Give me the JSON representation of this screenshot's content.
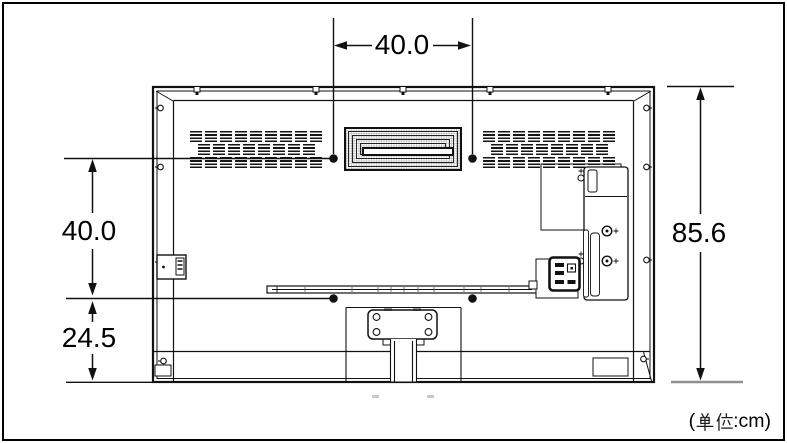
{
  "diagram": {
    "dimension_labels": {
      "top_width": "40.0",
      "side_upper": "40.0",
      "side_lower": "24.5",
      "height": "85.6"
    },
    "unit_note": {
      "open": "(",
      "kanji": "単位",
      "suffix": ":cm)"
    },
    "colors": {
      "line": "#111111",
      "background": "#ffffff",
      "muted_extension_line": "#909090"
    }
  }
}
